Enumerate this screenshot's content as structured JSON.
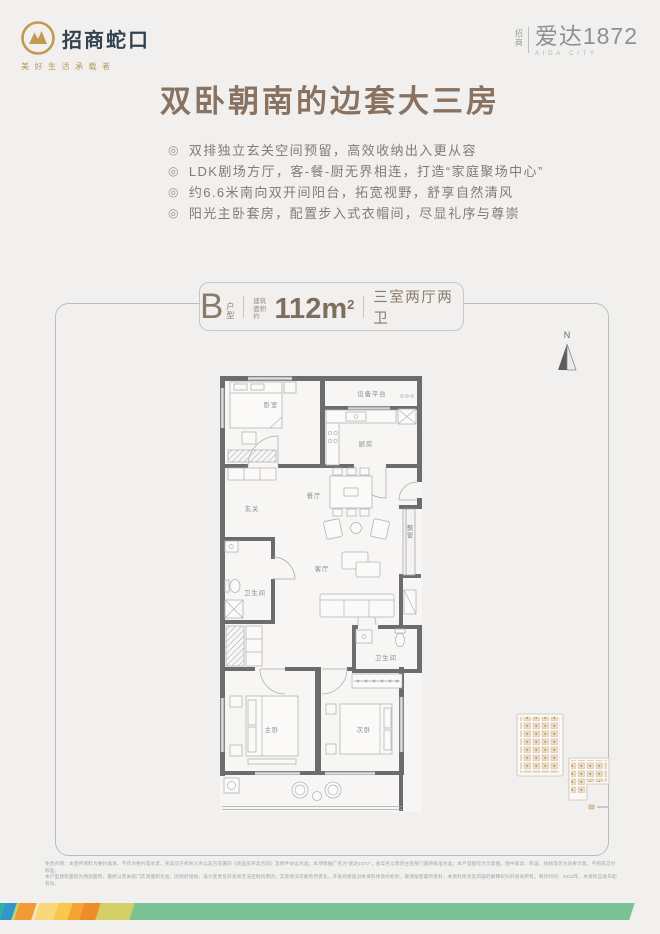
{
  "brand": {
    "logo_name": "招商蛇口",
    "logo_tagline": "美好生活承载者",
    "project_prefix_top": "招",
    "project_prefix_bottom": "商",
    "project_name": "爱达1872",
    "project_sub": "AIDA CITY"
  },
  "headline": {
    "text": "双卧朝南的边套大三房"
  },
  "features": {
    "bullet_char": "◎",
    "items": [
      "双排独立玄关空间预留，高效收纳出入更从容",
      "LDK剧场方厅，客-餐-厨无界相连，打造“家庭聚场中心”",
      "约6.6米南向双开间阳台，拓宽视野，舒享自然清风",
      "阳光主卧套房，配置步入式衣帽间，尽显礼序与尊崇"
    ]
  },
  "unit_badge": {
    "type_letter": "B",
    "type_label_top": "户",
    "type_label_bottom": "型",
    "area_label_top": "建筑",
    "area_label_bottom": "面积约",
    "area_value": "112m",
    "area_exponent": "2",
    "rooms_label": "三室两厅两卫"
  },
  "compass": {
    "label": "N"
  },
  "floorplan": {
    "rooms": {
      "bedroom_north": "卧室",
      "equipment_platform": "设备平台",
      "kitchen": "厨房",
      "foyer": "玄关",
      "dining": "餐厅",
      "living": "客厅",
      "bath_main": "卫生间",
      "bay_window": "飘窗",
      "bath_second": "卫生间",
      "master_bedroom": "主卧",
      "second_bedroom": "次卧"
    }
  },
  "disclaimer": {
    "line1": "免责声明：本宣传资料为要约邀请，不作为要约或承诺，买卖双方权利义务以双方签署的《商品房买卖合同》及附件协议为准；本项目推广名为“爱达1872”，备案名以政府主管部门最终核准为准；本户型图仅为示意图，图中家具、陈设、绿植等仅为效果示意，不构成交付标准。",
    "line2": "本户型建筑面积为预测面积，最终以有关部门实测面积为准；因政府规划、设计变更及开发商无法控制的原因，实际情况可能有所变化，开发商保留对本资料修改的权利，敬请留意最新资料；本资料所涉及内容的解释权归开发商所有。制作时间：2023年，本资料自发布起有效。"
  },
  "stripe": {
    "segments": [
      {
        "color": "#2fb2a2",
        "width": 10
      },
      {
        "color": "#3096cc",
        "width": 13
      },
      {
        "color": "#bfd36e",
        "width": 5
      },
      {
        "color": "#f29a36",
        "width": 19
      },
      {
        "color": "#f3e7c0",
        "width": 5
      },
      {
        "color": "#f8d878",
        "width": 21
      },
      {
        "color": "#f7c94a",
        "width": 16
      },
      {
        "color": "#f5a433",
        "width": 14
      },
      {
        "color": "#ee8c29",
        "width": 18
      },
      {
        "color": "#d5cf68",
        "width": 36
      },
      {
        "color": "#7cc295",
        "width": 500
      }
    ]
  }
}
